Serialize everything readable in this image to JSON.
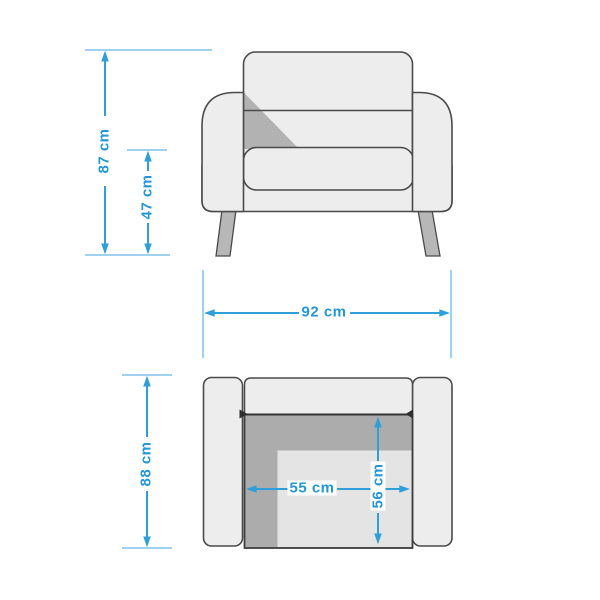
{
  "diagram": {
    "subject": "Armchair dimension drawing",
    "unit": "cm",
    "views": [
      {
        "id": "front",
        "name": "front-elevation-view",
        "dimensions": [
          "overall_height",
          "seat_height",
          "overall_width"
        ]
      },
      {
        "id": "top",
        "name": "top-plan-view",
        "dimensions": [
          "overall_depth",
          "seat_width",
          "seat_depth"
        ]
      }
    ],
    "dimensions": {
      "overall_height": {
        "value": 87,
        "unit": "cm",
        "label": "87 cm",
        "orientation": "vertical"
      },
      "seat_height": {
        "value": 47,
        "unit": "cm",
        "label": "47 cm",
        "orientation": "vertical"
      },
      "overall_width": {
        "value": 92,
        "unit": "cm",
        "label": "92 cm",
        "orientation": "horizontal"
      },
      "overall_depth": {
        "value": 88,
        "unit": "cm",
        "label": "88 cm",
        "orientation": "vertical"
      },
      "seat_width": {
        "value": 55,
        "unit": "cm",
        "label": "55 cm",
        "orientation": "horizontal"
      },
      "seat_depth": {
        "value": 56,
        "unit": "cm",
        "label": "56 cm",
        "orientation": "vertical"
      }
    },
    "colors": {
      "dimension_blue": "#2E9FD9",
      "extension_line_blue": "#7EC3E8",
      "furniture_fill": "#EDEDED",
      "furniture_outline": "#4A4A4A",
      "shadow_gray": "#ACACAC",
      "leg_gray": "#B7B7B7",
      "background": "#FFFFFF"
    }
  }
}
